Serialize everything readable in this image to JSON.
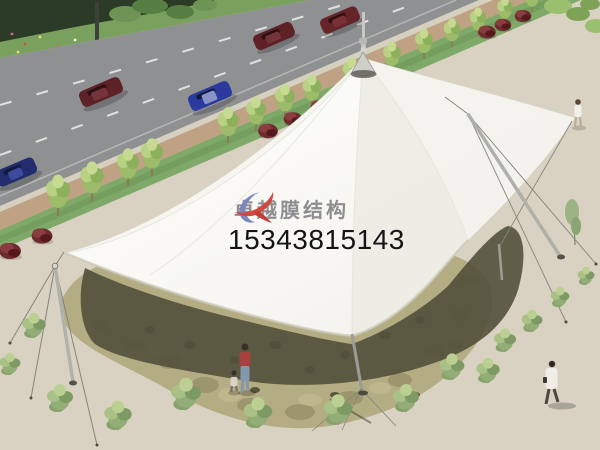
{
  "watermark": {
    "brand": "卓越膜结构",
    "phone": "15343815143"
  },
  "scene": {
    "description": "Aerial architectural rendering of a white multi-peak tensile membrane canopy over a flagstone plaza beside a multi-lane road",
    "membrane": "white tensile fabric cone with steel finial mast, tilted side masts and guy cables",
    "vehicles": [
      "maroon sedan",
      "maroon sedan",
      "maroon sedan",
      "dark blue sedan",
      "dark blue sedan"
    ],
    "people": [
      "pedestrian at top right",
      "woman with child under canopy",
      "man in white coat at bottom right"
    ]
  },
  "palette": {
    "membrane_white": "#fcfbf8",
    "road_gray": "#8e9091",
    "sand": "#d9d2c3",
    "paving_khaki": "#b4ac82",
    "shadow_olive": "#52503b",
    "grass_green": "#7fa968",
    "bush_maroon": "#6d2b2e",
    "car_red": "#5d2126",
    "car_blue": "#2b3a9e",
    "logo_red": "#d04840",
    "logo_blue": "#7d87bf",
    "brand_text": "#8e8e91",
    "phone_text": "#141414"
  }
}
